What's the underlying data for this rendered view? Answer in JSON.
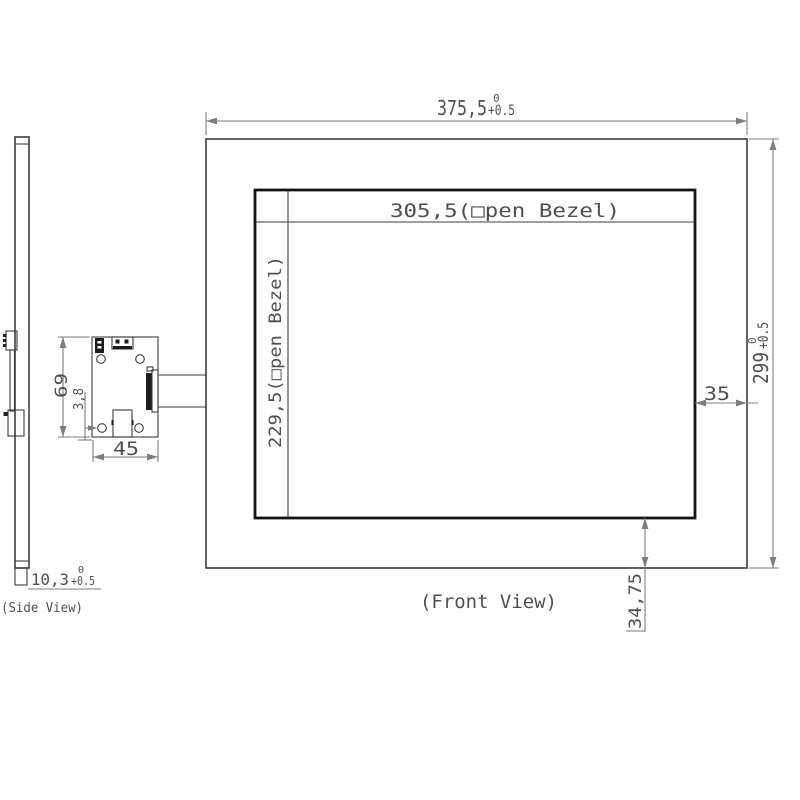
{
  "front_view": {
    "label": "(Front View)",
    "overall_width": {
      "value": "375,5",
      "tol_upper": "0",
      "tol_lower": "+0.5"
    },
    "overall_height": {
      "value": "299",
      "tol_upper": "0",
      "tol_lower": "+0.5"
    },
    "open_bezel_width": "305,5(□pen Bezel)",
    "open_bezel_height": "229,5(□pen Bezel)",
    "bezel_right_offset": "35",
    "bezel_bottom_offset": "34,75"
  },
  "side_view": {
    "label": "(Side View)",
    "thickness": {
      "value": "10,3",
      "tol_upper": "0",
      "tol_lower": "+0.5"
    }
  },
  "board_detail": {
    "board_height": "69",
    "hole_offset": "3,8",
    "board_width": "45"
  }
}
